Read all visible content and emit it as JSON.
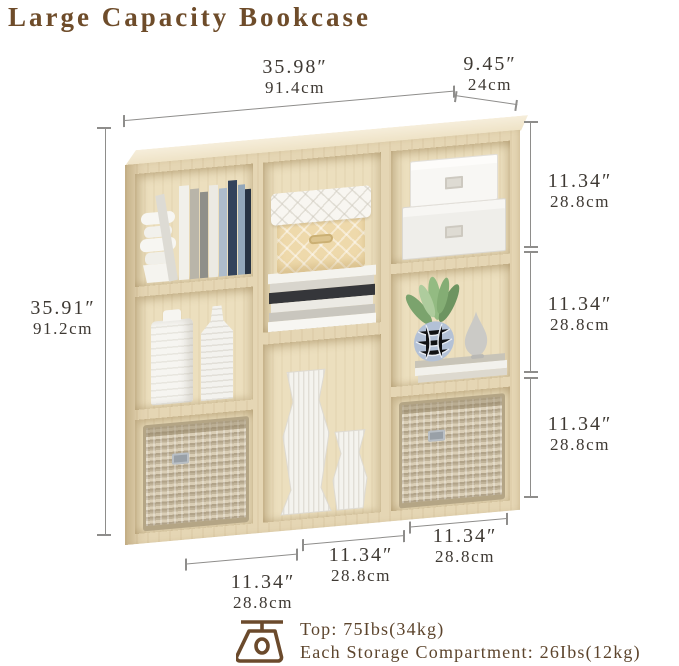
{
  "title": "Large Capacity Bookcase",
  "colors": {
    "title_brown": "#6e4c2a",
    "dimension_text": "#3e3933",
    "line_gray": "#8e8d8b",
    "wood": "#e5d6b4",
    "capacity_brown": "#5d452d"
  },
  "dims": {
    "width": {
      "inches": "35.98″",
      "cm": "91.4cm"
    },
    "depth": {
      "inches": "9.45″",
      "cm": "24cm"
    },
    "height": {
      "inches": "35.91″",
      "cm": "91.2cm"
    },
    "right": [
      {
        "inches": "11.34″",
        "cm": "28.8cm"
      },
      {
        "inches": "11.34″",
        "cm": "28.8cm"
      },
      {
        "inches": "11.34″",
        "cm": "28.8cm"
      }
    ],
    "bottom": [
      {
        "inches": "11.34″",
        "cm": "28.8cm"
      },
      {
        "inches": "11.34″",
        "cm": "28.8cm"
      },
      {
        "inches": "11.34″",
        "cm": "28.8cm"
      }
    ]
  },
  "capacity": {
    "icon": "scale-icon",
    "top": "Top: 75Ibs(34kg)",
    "each": "Each Storage Compartment: 26Ibs(12kg)"
  }
}
